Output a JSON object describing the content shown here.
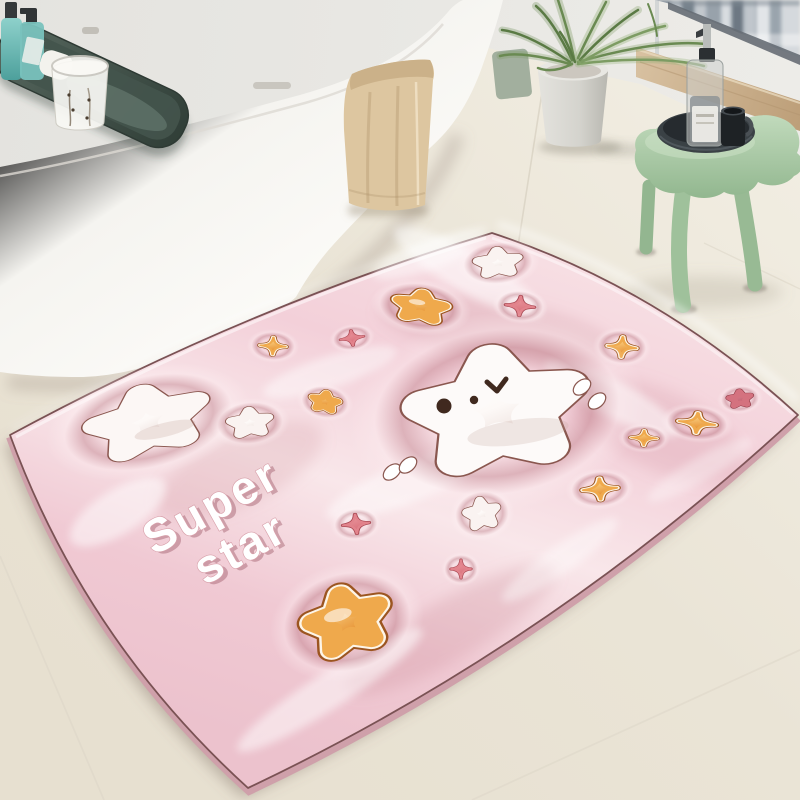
{
  "mat": {
    "text_line1": "Super",
    "text_line2": "star",
    "base_color": "#f4d4db",
    "edge_color": "#7a5254",
    "text_color": "#ffffff",
    "face_color": "#40291f",
    "star_colors": {
      "white": "#ffffff",
      "orange": "#f3b35c",
      "pink": "#e58d95",
      "deep_pink": "#d26b7a"
    },
    "design_elements": {
      "white_stars": 5,
      "orange_stars": 3,
      "orange_sparkles": 5,
      "pink_sparkles": 4,
      "deep_pink_star": 1,
      "white_accent_marks": 4,
      "face": "winking-bear-face"
    }
  },
  "scene": {
    "floor_color": "#eae4d6",
    "wall_color": "#e7e6e0",
    "bathtub_color": "#f8f7f3",
    "towel_color": "#dcc49e",
    "stool_color": "#a5c6a3",
    "plant_color": "#7b9a5e",
    "pot_color": "#d8d7d1",
    "bath_caddy_color": "#45524c",
    "stool_tray_color": "#33393d",
    "window_view": "city skyline"
  }
}
